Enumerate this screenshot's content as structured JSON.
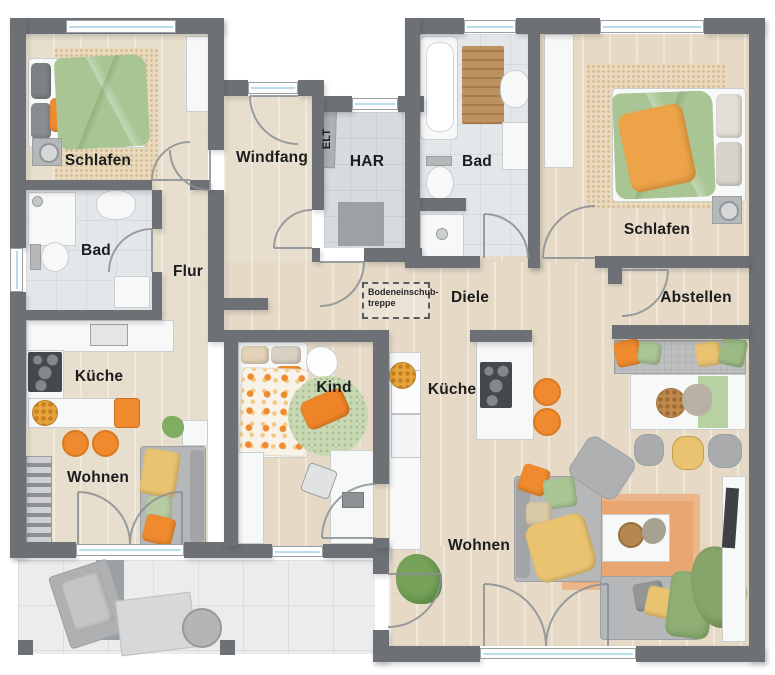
{
  "plan_title": "Bungalow Grundriss",
  "rooms": [
    {
      "id": "schlafen-left",
      "label": "Schlafen"
    },
    {
      "id": "bad-left",
      "label": "Bad"
    },
    {
      "id": "flur",
      "label": "Flur"
    },
    {
      "id": "windfang",
      "label": "Windfang"
    },
    {
      "id": "elt",
      "label": "ELT"
    },
    {
      "id": "har",
      "label": "HAR"
    },
    {
      "id": "bad-right",
      "label": "Bad"
    },
    {
      "id": "schlafen-right",
      "label": "Schlafen"
    },
    {
      "id": "diele",
      "label": "Diele"
    },
    {
      "id": "abstellen",
      "label": "Abstellen"
    },
    {
      "id": "kueche-left",
      "label": "Küche"
    },
    {
      "id": "kind",
      "label": "Kind"
    },
    {
      "id": "kueche-right",
      "label": "Küche"
    },
    {
      "id": "wohnen-left",
      "label": "Wohnen"
    },
    {
      "id": "wohnen-right",
      "label": "Wohnen"
    }
  ],
  "stairs_label": {
    "line1": "Bodeneinschub-",
    "line2": "treppe"
  },
  "colors": {
    "wall": "#6d7175",
    "wood": "#e8decd",
    "wood2": "#e6dac7",
    "tile": "#e4e7e9",
    "tiled": "#d8dbde",
    "terrace": "#ececec",
    "glass": "#b9dcea",
    "orange": "#ef8b2e",
    "green": "#a9c594",
    "yellow": "#e9c370",
    "krug": "#c7d8b2",
    "orug": "#e9a671",
    "fgrey": "#b5b7b9",
    "fwhite": "#f7f8f8"
  }
}
